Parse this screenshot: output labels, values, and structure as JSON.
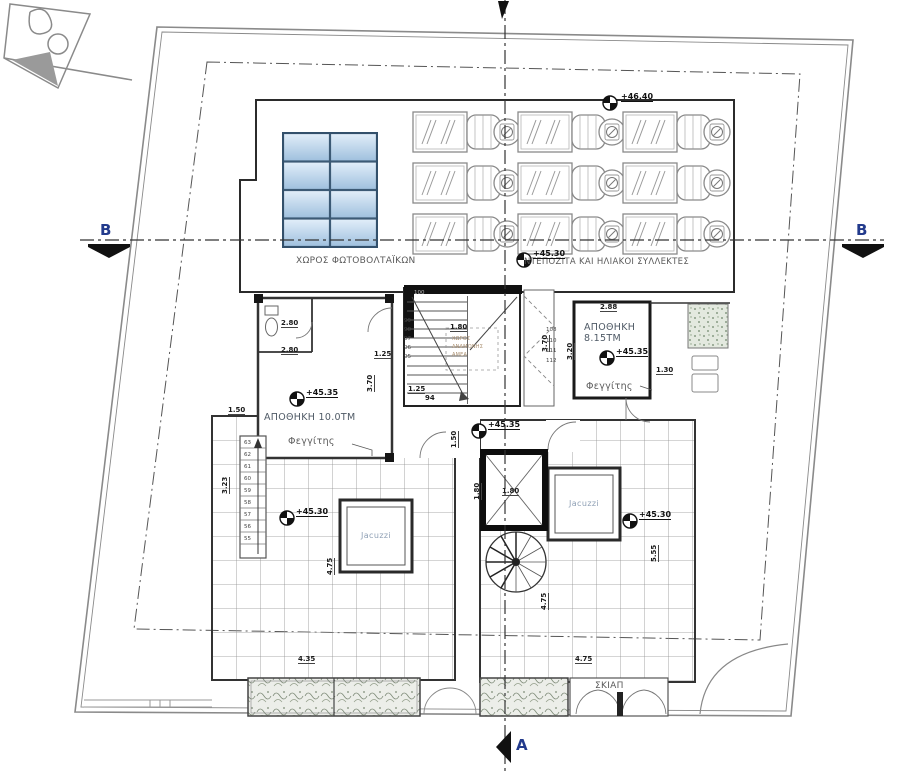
{
  "document": {
    "type": "architectural roof floor plan"
  },
  "colors": {
    "pv_panel_light": "#e2eef9",
    "pv_panel_dark": "#9fc0de",
    "line": "#333333",
    "section_letter": "#223a8c",
    "vegetation": "#7d8a77"
  },
  "section_markers": {
    "left": "B",
    "right": "B",
    "bottom": "A"
  },
  "areas": {
    "pv_label": "ΧΩΡΟΣ ΦΩΤΟΒΟΛΤΑΪΚΩΝ",
    "collectors_label": "ΝΤΕΠΟΖΙΤΑ ΚΑΙ ΗΛΙΑΚΟΙ ΣΥΛΛΕΚΤΕΣ",
    "storage_left": "ΑΠΟΘΗΚΗ 10.0ΤΜ",
    "storage_right_name": "ΑΠΟΘΗΚΗ",
    "storage_right_area": "8.15ΤΜ",
    "skylight_left": "Φεγγίτης",
    "skylight_right": "Φεγγίτης",
    "waiting_1": "ΧΩΡΟΣ",
    "waiting_2": "ΑΝΑΜΟΝΗΣ",
    "waiting_3": "ΑΜΕΑ",
    "jacuzzi_left": "Jacuzzi",
    "jacuzzi_right": "Jacuzzi",
    "shade_label": "ΣΚΙΑΠ"
  },
  "elevations": {
    "roof": "+46.40",
    "pv_deck": "+45.30",
    "storage_left": "+45.35",
    "storage_right": "+45.35",
    "landing": "+45.35",
    "terrace_left": "+45.30",
    "terrace_right": "+45.30"
  },
  "dimensions": {
    "left_room_w1": "2.80",
    "left_room_w2": "2.80",
    "left_room_d1": "1.25",
    "left_room_h": "3.70",
    "left_wall": "1.50",
    "core_w": "1.80",
    "core_d": "1.25",
    "core_h": "3.70",
    "right_room_w": "2.88",
    "right_room_h": "3.20",
    "right_planter": "1.30",
    "shaft_w": "1.80",
    "shaft_h": "1.80",
    "corridor": "1.50",
    "terrace_left_h": "4.75",
    "terrace_left_w": "4.35",
    "stair_side": "3.23",
    "terrace_right_w": "4.75",
    "spiral_h": "4.75",
    "terrace_right_h": "5.55",
    "landing_step": "94"
  },
  "stairs": {
    "terrace_steps": [
      "63",
      "62",
      "61",
      "60",
      "59",
      "58",
      "57",
      "56",
      "55"
    ],
    "core_left": [
      "100",
      "99",
      "98",
      "97",
      "96",
      "95"
    ],
    "core_right": [
      "108",
      "110",
      "111",
      "112"
    ]
  }
}
